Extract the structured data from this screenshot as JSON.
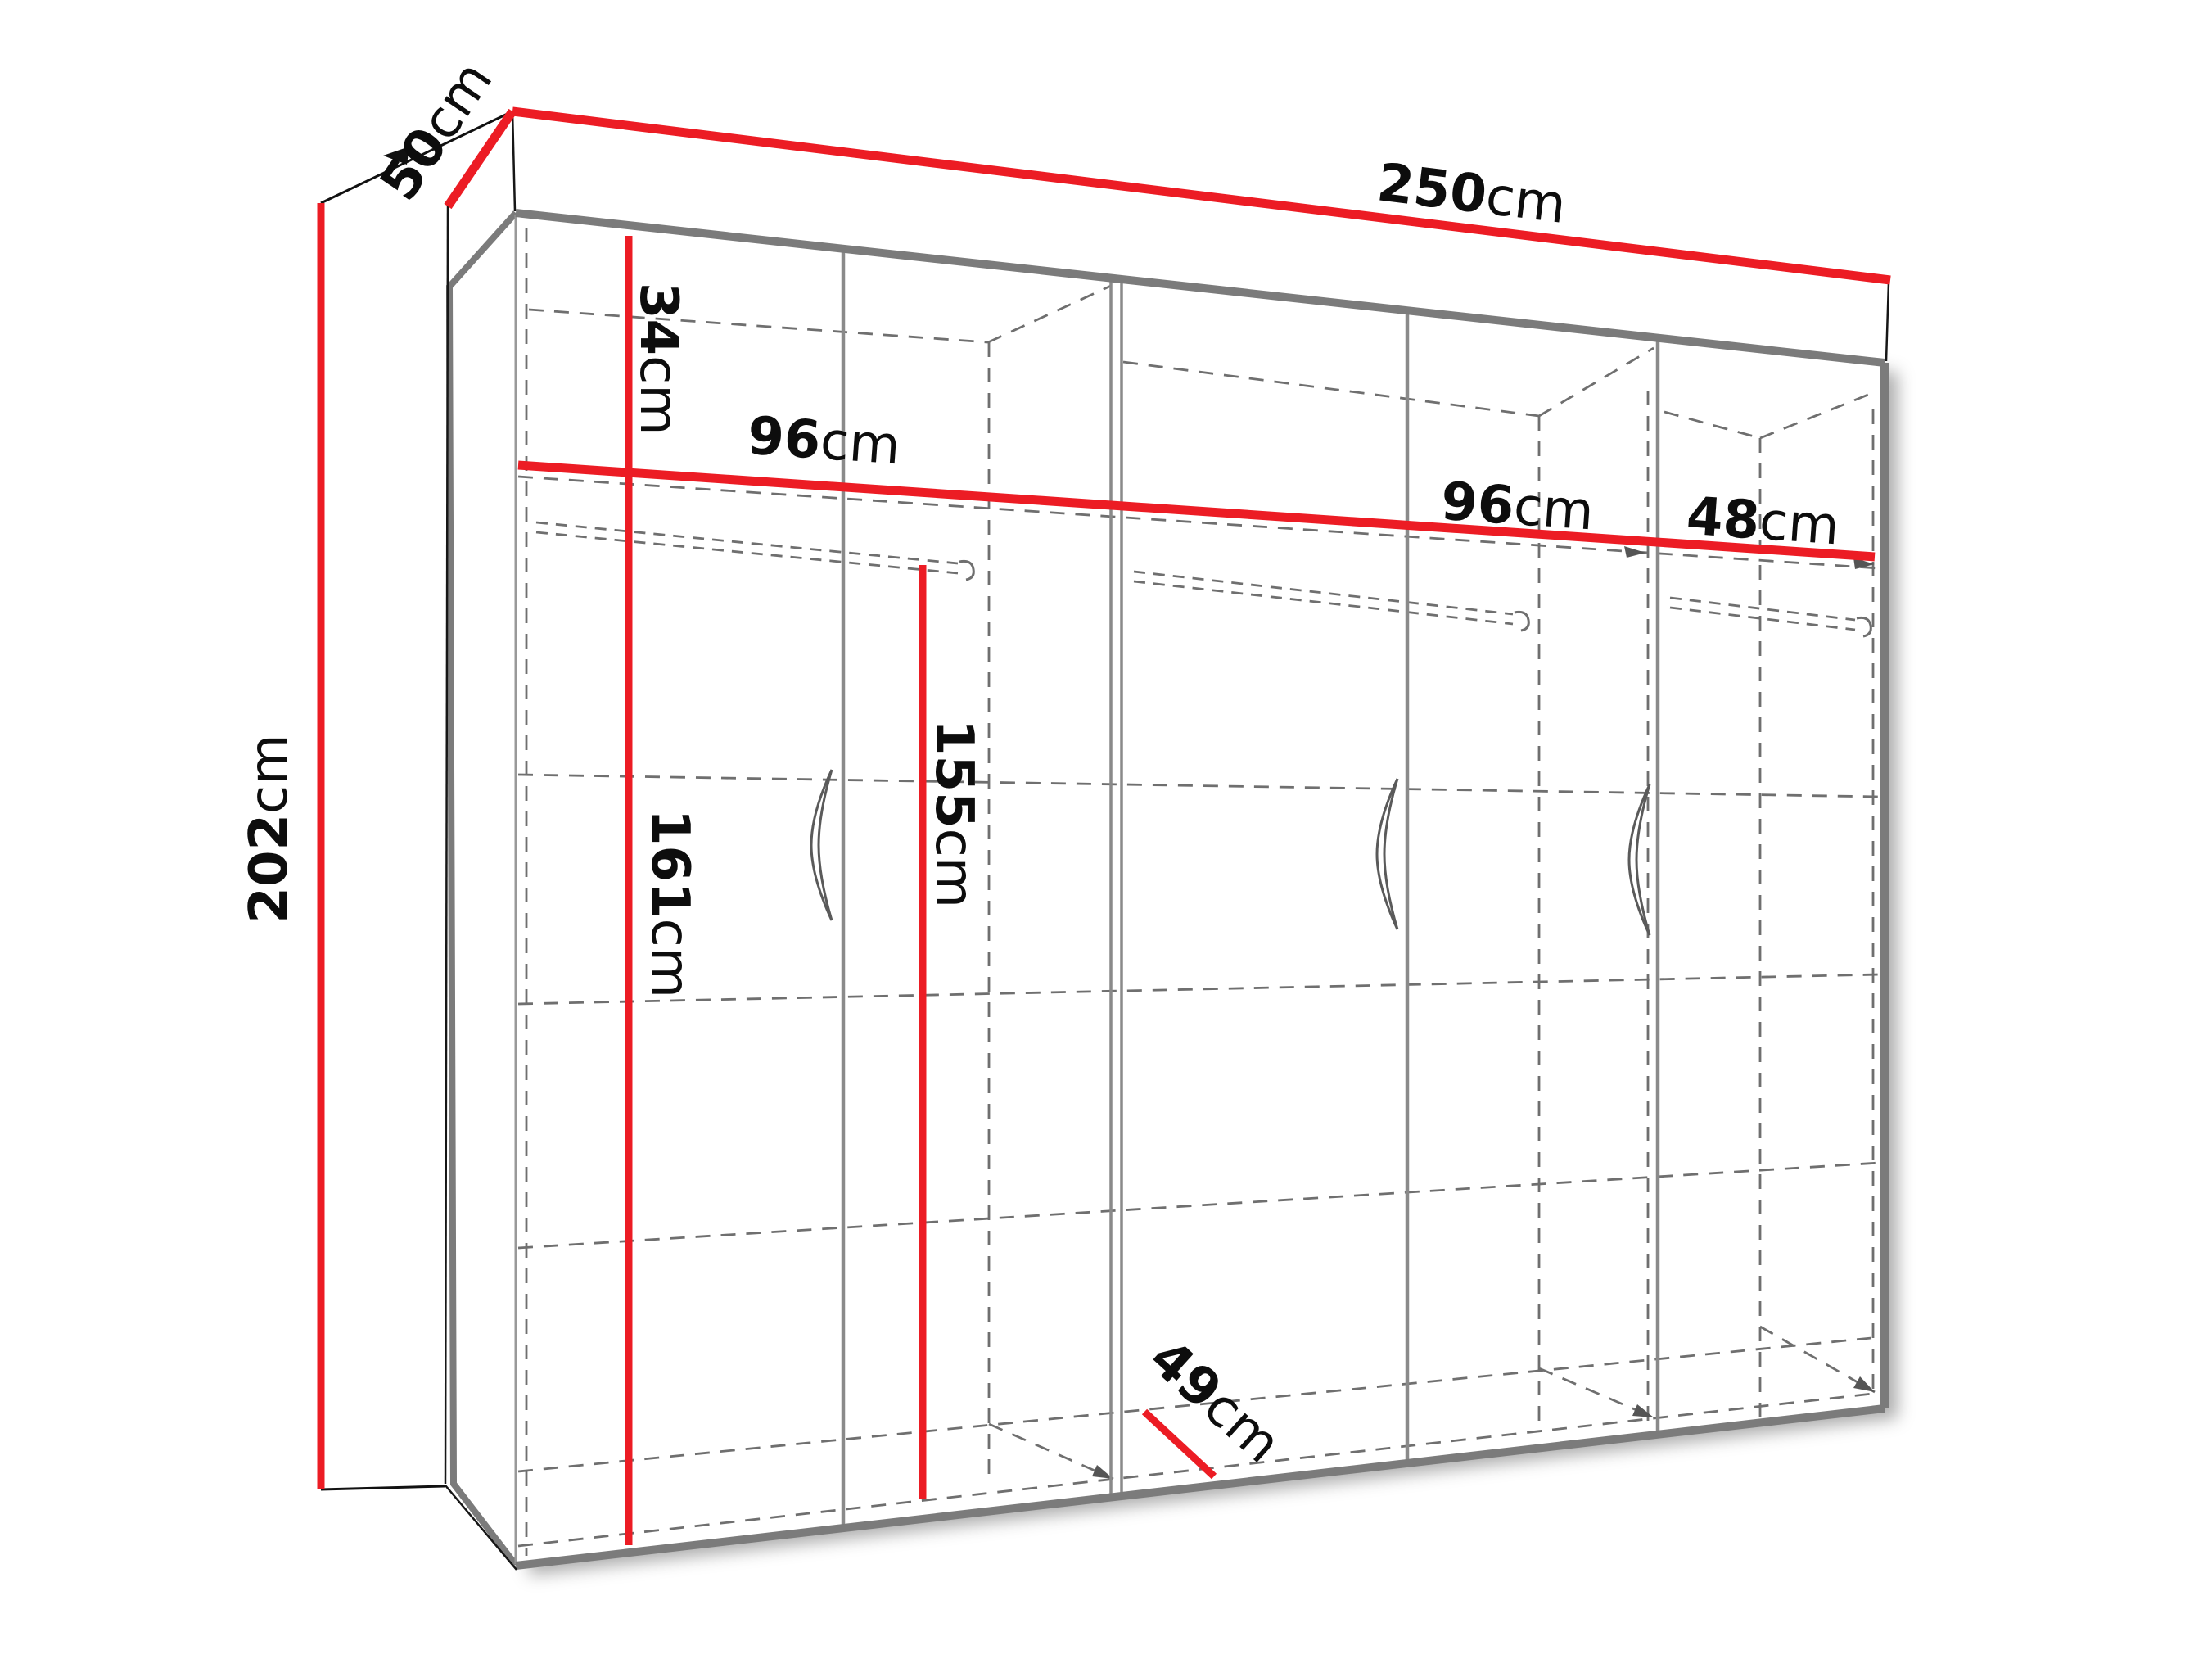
{
  "diagram": {
    "type": "furniture-technical-drawing",
    "subject": "three-section wardrobe with dimension lines",
    "unit": "cm",
    "colors": {
      "dimension_line": "#EC1C24",
      "edge_gray": "#7b7b7b",
      "divider_gray": "#8a8a8a",
      "dashed_gray": "#6f6f6f",
      "text": "#0d0d0d",
      "background": "#ffffff"
    },
    "dimensions": {
      "total_width": {
        "value": "250",
        "unit": "cm"
      },
      "total_depth": {
        "value": "50",
        "unit": "cm"
      },
      "total_height": {
        "value": "202",
        "unit": "cm"
      },
      "top_section_height": {
        "value": "34",
        "unit": "cm"
      },
      "left_section_width": {
        "value": "96",
        "unit": "cm"
      },
      "middle_section_width": {
        "value": "96",
        "unit": "cm"
      },
      "right_section_width": {
        "value": "48",
        "unit": "cm"
      },
      "left_interior_height": {
        "value": "161",
        "unit": "cm"
      },
      "hanging_space_height": {
        "value": "155",
        "unit": "cm"
      },
      "interior_depth": {
        "value": "49",
        "unit": "cm"
      }
    }
  }
}
